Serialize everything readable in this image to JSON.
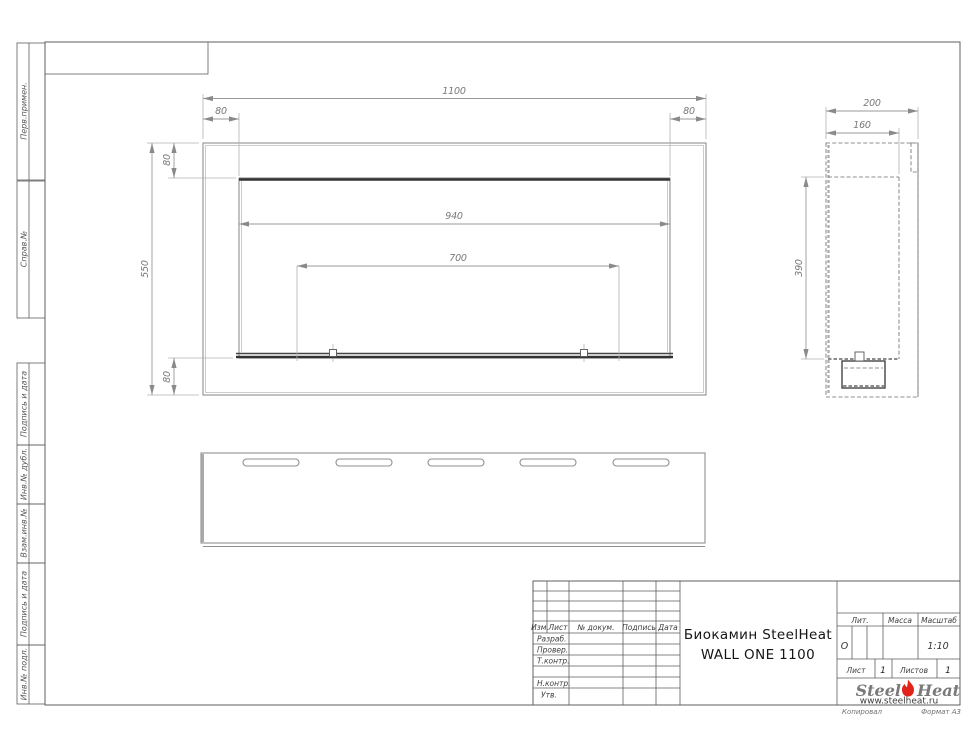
{
  "left_margin": {
    "labels": [
      "Перв.примен.",
      "Справ.№",
      "Подпись и дата",
      "Инв.№ дубл.",
      "Взам.инв.№",
      "Подпись и дата",
      "Инв.№ подл."
    ]
  },
  "views": {
    "front": {
      "dims": {
        "width": "1100",
        "inner_width": "940",
        "burner_width": "700",
        "height": "550",
        "top": "80",
        "bottom": "80",
        "left": "80",
        "right": "80"
      }
    },
    "side": {
      "dims": {
        "depth": "200",
        "inner_depth": "160",
        "height": "390"
      }
    }
  },
  "title_block": {
    "header_cols": [
      "Изм.",
      "Лист",
      "№ докум.",
      "Подпись",
      "Дата"
    ],
    "rows": [
      "Разраб.",
      "Провер.",
      "Т.контр.",
      "Н.контр.",
      "Утв."
    ],
    "title_line1": "Биокамин SteelHeat",
    "title_line2": "WALL ONE 1100",
    "lit_label": "Лит.",
    "lit_value": "О",
    "mass_label": "Масса",
    "scale_label": "Масштаб",
    "scale_value": "1:10",
    "sheet_label": "Лист",
    "sheet_value": "1",
    "sheets_label": "Листов",
    "sheets_value": "1",
    "logo_steel": "Steel",
    "logo_heat": "Heat",
    "logo_url": "www.steelheat.ru",
    "footer_left": "Копировал",
    "footer_right": "Формат А3"
  },
  "colors": {
    "flame_red": "#e2231a",
    "line_gray": "#8f8f8f",
    "feature_dark": "#333333"
  }
}
